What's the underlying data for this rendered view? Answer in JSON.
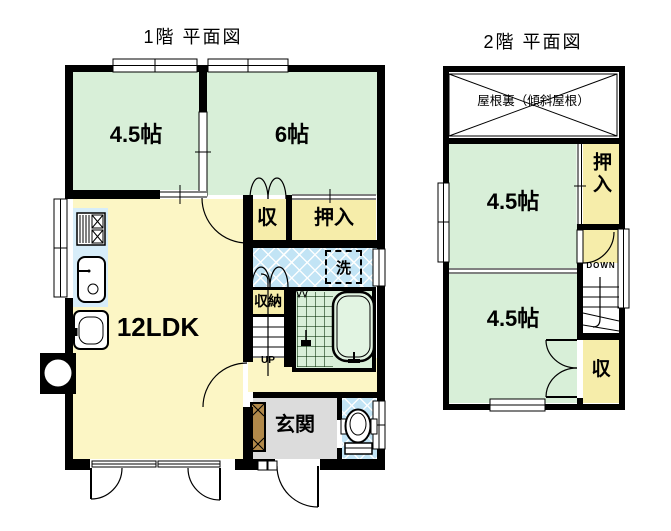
{
  "floor1": {
    "title": "1階 平面図",
    "rooms": {
      "room_45": "4.5帖",
      "room_6": "6帖",
      "ldk": "12LDK",
      "closet_shu": "収",
      "oshiire": "押入",
      "storage": "収納",
      "laundry": "洗",
      "entrance": "玄関",
      "stairs_up": "UP"
    }
  },
  "floor2": {
    "title": "2階 平面図",
    "attic": "屋根裏（傾斜屋根）",
    "rooms": {
      "room_45_upper": "4.5帖",
      "room_45_lower": "4.5帖",
      "oshiire": "押入",
      "closet_shu": "収",
      "stairs_down": "DOWN"
    }
  },
  "colors": {
    "room_green": "#d8efd8",
    "ldk_yellow": "#fcf6c5",
    "closet_yellow": "#f6edaa",
    "water_blue": "#c2e4f5",
    "kitchen_blue": "#d7edf9",
    "entry_gray": "#dcdcdc",
    "cabinet_brown": "#b1894a",
    "wall_black": "#000000"
  }
}
